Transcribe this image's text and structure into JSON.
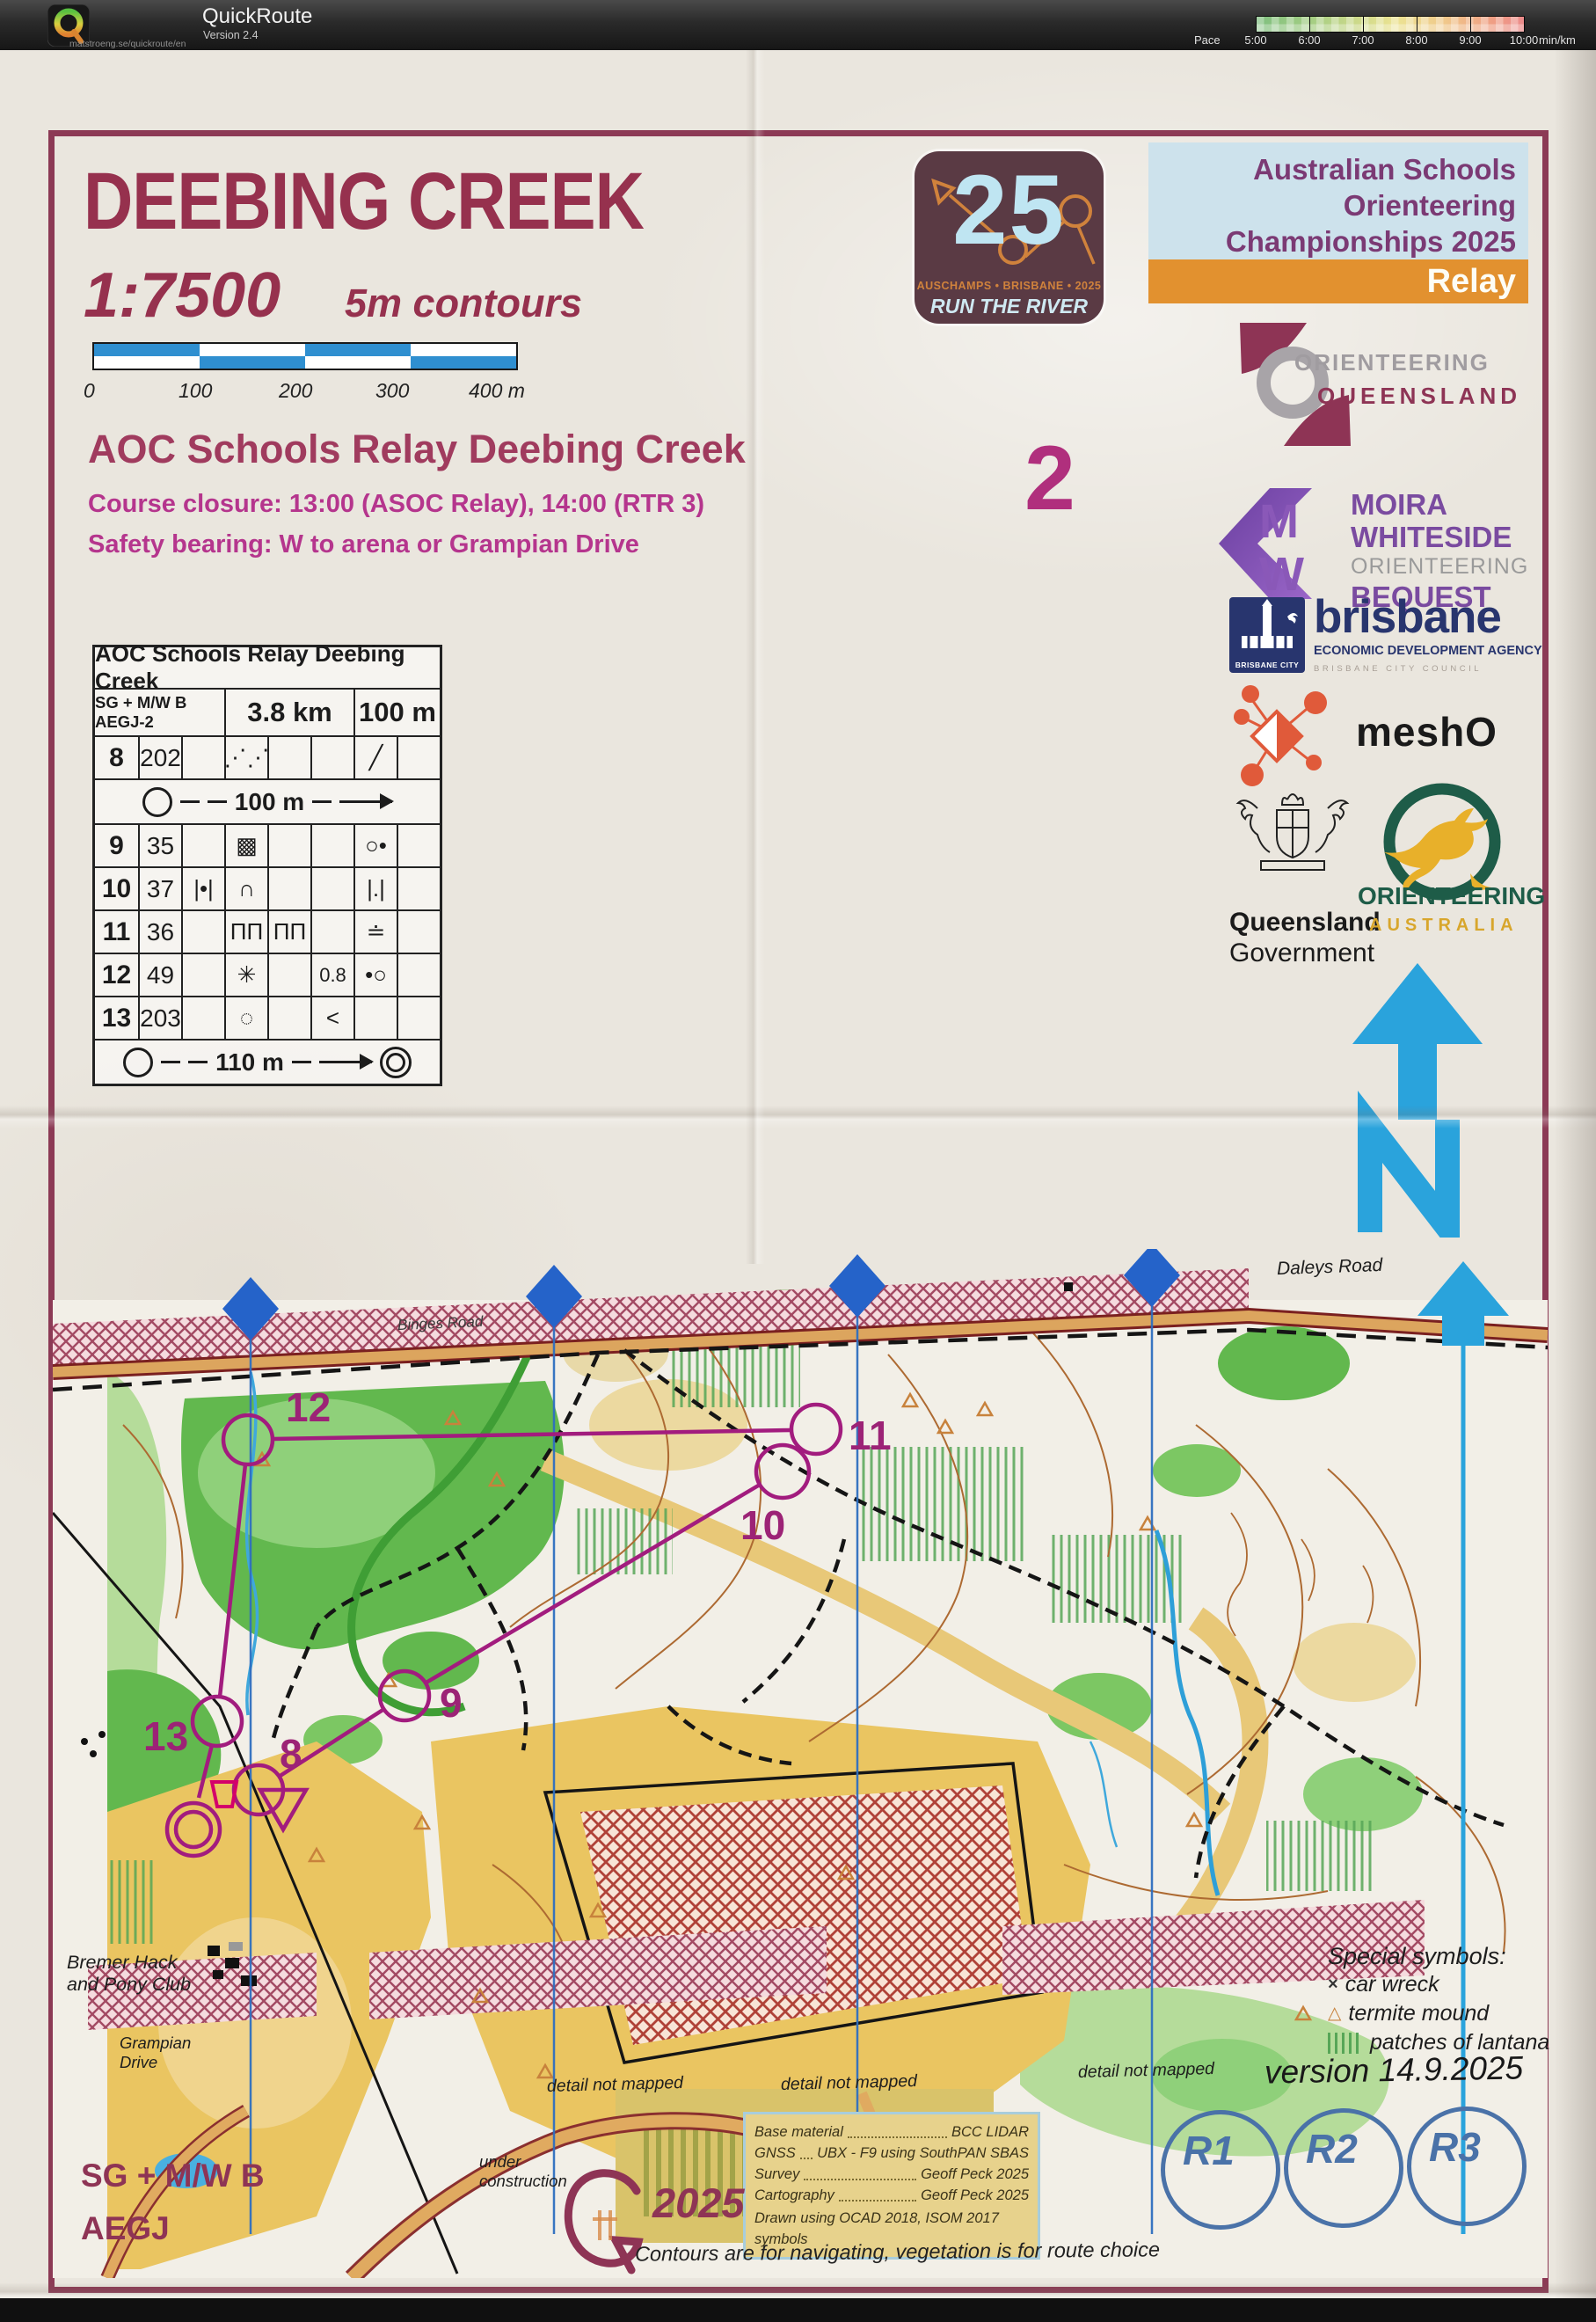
{
  "app": {
    "name": "QuickRoute",
    "version": "Version 2.4",
    "url": "matstroeng.se/quickroute/en",
    "pace": {
      "label": "Pace",
      "ticks": [
        "5:00",
        "6:00",
        "7:00",
        "8:00",
        "9:00",
        "10:00"
      ],
      "unit": "min/km"
    }
  },
  "header": {
    "title": "DEEBING CREEK",
    "scale": "1:7500",
    "contours": "5m contours",
    "scalebar": [
      "0",
      "100",
      "200",
      "300",
      "400 m"
    ],
    "event": "AOC Schools Relay Deebing Creek",
    "closure": "Course closure: 13:00 (ASOC Relay), 14:00 (RTR 3)",
    "safety": "Safety bearing: W to arena or Grampian Drive",
    "leg_number": "2"
  },
  "card": {
    "title": "AOC Schools Relay Deebing Creek",
    "cls": "SG + M/W B AEGJ-2",
    "dist": "3.8 km",
    "climb": "100 m",
    "rows": [
      {
        "a": "8",
        "b": "202",
        "c": "",
        "d": "⋰⋰",
        "e": "",
        "f": "",
        "g": "╱",
        "h": ""
      },
      {
        "a": "9",
        "b": "35",
        "c": "",
        "d": "▩",
        "e": "",
        "f": "",
        "g": "○•",
        "h": ""
      },
      {
        "a": "10",
        "b": "37",
        "c": "|•|",
        "d": "∩",
        "e": "",
        "f": "",
        "g": "|.|",
        "h": ""
      },
      {
        "a": "11",
        "b": "36",
        "c": "",
        "d": "ΠΠ",
        "e": "ΠΠ",
        "f": "",
        "g": "≐",
        "h": ""
      },
      {
        "a": "12",
        "b": "49",
        "c": "",
        "d": "✳",
        "e": "",
        "f": "0.8",
        "g": "•○",
        "h": ""
      },
      {
        "a": "13",
        "b": "203",
        "c": "",
        "d": "◌",
        "e": "",
        "f": "<",
        "g": "",
        "h": ""
      }
    ],
    "leg1_dist": "100 m",
    "finish_dist": "110 m"
  },
  "banner": {
    "line1": "Australian Schools",
    "line2": "Orienteering",
    "line3": "Championships 2025",
    "tag": "Relay"
  },
  "logo25": {
    "number": "25",
    "line1": "AUSCHAMPS • BRISBANE • 2025",
    "line2": "RUN THE RIVER"
  },
  "logos": {
    "oq": {
      "l1": "ORIENTEERING",
      "l2": "QUEENSLAND"
    },
    "mw": {
      "l1": "MOIRA",
      "l2": "WHITESIDE",
      "l3": "ORIENTEERING",
      "l4": "BEQUEST"
    },
    "brisbane": {
      "name": "brisbane",
      "l2": "ECONOMIC DEVELOPMENT AGENCY",
      "l3": "BRISBANE CITY COUNCIL",
      "badge": "BRISBANE CITY"
    },
    "mesho": {
      "name": "meshO"
    },
    "qld": {
      "l1": "Queensland",
      "l2": "Government"
    },
    "oa": {
      "l1": "ORIENTEERING",
      "l2": "AUSTRALIA"
    }
  },
  "map": {
    "roads": {
      "binges": "Binges Road",
      "daleys": "Daleys Road"
    },
    "controls": [
      {
        "label": "8"
      },
      {
        "label": "9"
      },
      {
        "label": "10"
      },
      {
        "label": "11"
      },
      {
        "label": "12"
      },
      {
        "label": "13"
      }
    ],
    "notes": {
      "pony1": "Bremer Hack",
      "pony2": "and Pony Club",
      "grampian1": "Grampian",
      "grampian2": "Drive",
      "under1": "under",
      "under2": "construction",
      "detail": "detail not mapped"
    },
    "special": {
      "title": "Special symbols:",
      "car_sym": "×",
      "car": "car wreck",
      "termite_sym": "△",
      "termite": "termite mound",
      "lantana": "patches of lantana"
    },
    "version": "version 14.9.2025"
  },
  "credits": {
    "rows": [
      {
        "k": "Base material",
        "v": "BCC LIDAR"
      },
      {
        "k": "GNSS",
        "v": "UBX - F9 using SouthPAN SBAS"
      },
      {
        "k": "Survey",
        "v": "Geoff Peck 2025"
      },
      {
        "k": "Cartography",
        "v": "Geoff Peck 2025"
      }
    ],
    "last": "Drawn using OCAD 2018,  ISOM 2017 symbols"
  },
  "footer": {
    "g_year": "2025",
    "tagline": "Contours are for navigating, vegetation is for route choice",
    "legs": [
      "R1",
      "R2",
      "R3"
    ],
    "cls1": "SG + M/W B",
    "cls2": "AEGJ"
  },
  "colors": {
    "maroon": "#8e3455",
    "magenta": "#b5358d",
    "course_purple": "#a21c7e",
    "cyan_north": "#2aa3dc",
    "banner_blue": "#cde2ec",
    "banner_purple": "#7b3a74",
    "relay_orange": "#e2912f",
    "paper": "#eae6de"
  }
}
